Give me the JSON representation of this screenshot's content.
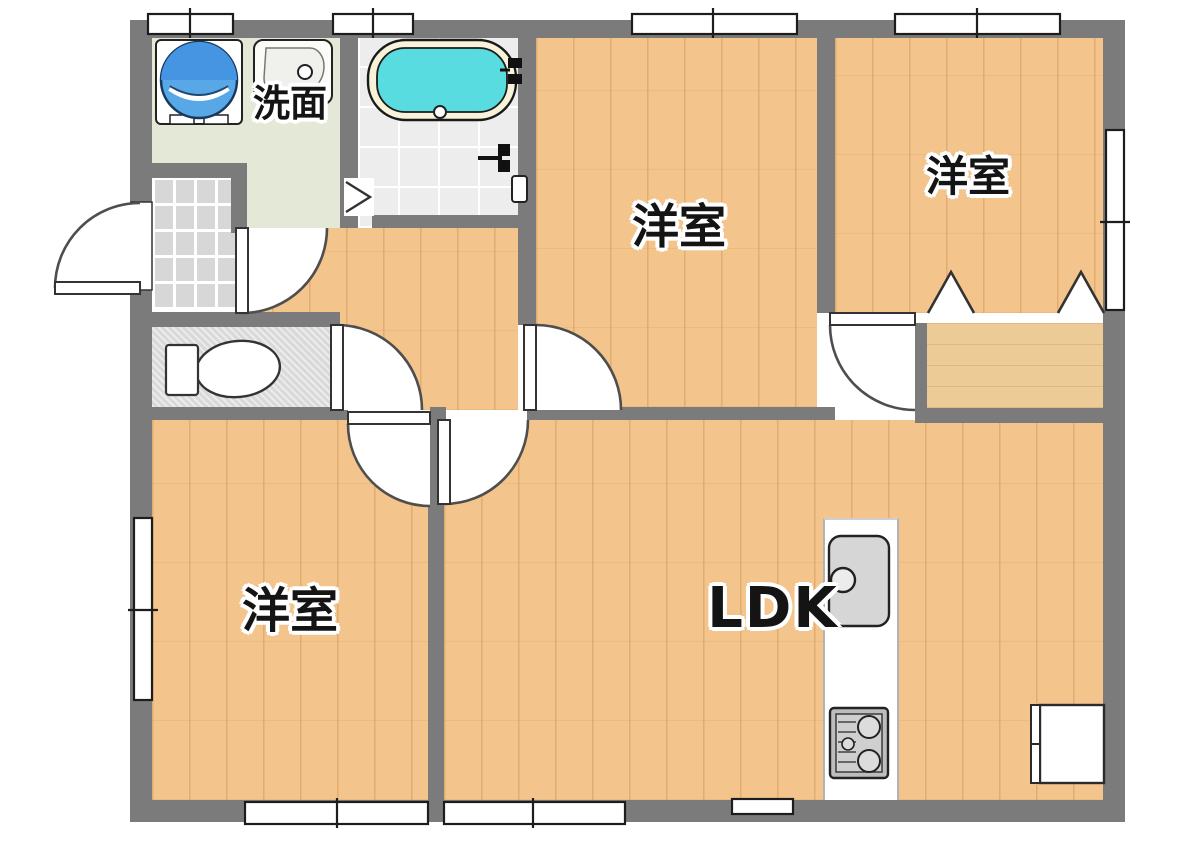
{
  "rooms": {
    "washroom": {
      "label": "洗面"
    },
    "bedroom_top_middle": {
      "label": "洋室"
    },
    "bedroom_top_right": {
      "label": "洋室"
    },
    "bedroom_bottom_left": {
      "label": "洋室"
    },
    "ldk": {
      "label": "LDK"
    }
  },
  "icons": {
    "washing_machine": "washing-machine-icon",
    "washbasin": "washbasin-icon",
    "bathtub": "bathtub-icon",
    "shower_mixer": "shower-mixer-icon",
    "bathroom_folding_door": "folding-door-icon",
    "toilet": "toilet-icon",
    "kitchen_sink": "kitchen-sink-icon",
    "stove": "stove-icon",
    "refrigerator_space": "refrigerator-space-icon",
    "closet_bifold_doors": "closet-bifold-icon",
    "door_swing": "door-swing-icon",
    "window": "window-icon",
    "entrance_door": "entrance-door-icon"
  },
  "colors": {
    "background": "#ffffff",
    "wall": "#7b7b7b",
    "wood_floor": "#f3c48c",
    "washroom_floor": "#e4e9d7",
    "bathroom_floor": "#ededed",
    "genkan_tile": "#d7d7d7",
    "toilet_floor": "#d9d9d9",
    "closet_floor": "#eccb97",
    "bath_water": "#59dce0",
    "tub_rim": "#f7f2d8",
    "washer_blue": "#58a8e8",
    "counter_gray": "#d6d6d6"
  }
}
